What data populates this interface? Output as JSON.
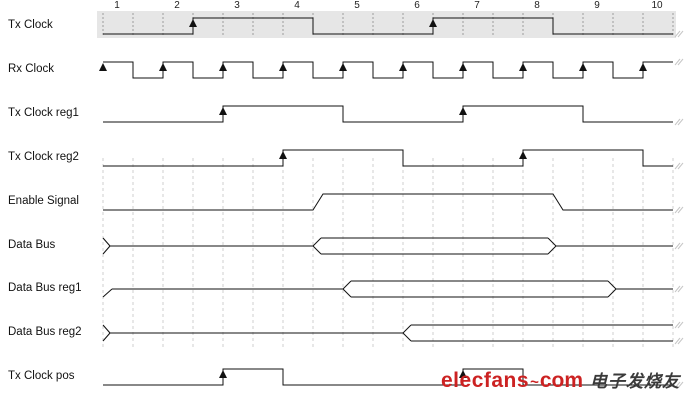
{
  "timeline": {
    "tick_labels": [
      "1",
      "2",
      "3",
      "4",
      "5",
      "6",
      "7",
      "8",
      "9",
      "10"
    ]
  },
  "colors": {
    "line": "#111111",
    "band_fill": "#e6e6e6",
    "band_dash": "#9c9c9c",
    "grid_dash": "#cfcfcf",
    "end_mark": "#c6c6c6",
    "watermark_red": "#cc2222",
    "watermark_cn": "#3a3a3a"
  },
  "signals": [
    {
      "name": "tx-clock",
      "label": "Tx Clock",
      "kind": "binary",
      "band": true,
      "levels": [
        [
          0,
          3,
          "low"
        ],
        [
          3,
          7,
          "high"
        ],
        [
          7,
          11,
          "low"
        ],
        [
          11,
          15,
          "high"
        ],
        [
          15,
          19,
          "low"
        ]
      ],
      "arrows": [
        3,
        11
      ],
      "slant": false
    },
    {
      "name": "rx-clock",
      "label": "Rx Clock",
      "kind": "binary",
      "levels": [
        [
          0,
          1,
          "high"
        ],
        [
          1,
          2,
          "low"
        ],
        [
          2,
          3,
          "high"
        ],
        [
          3,
          4,
          "low"
        ],
        [
          4,
          5,
          "high"
        ],
        [
          5,
          6,
          "low"
        ],
        [
          6,
          7,
          "high"
        ],
        [
          7,
          8,
          "low"
        ],
        [
          8,
          9,
          "high"
        ],
        [
          9,
          10,
          "low"
        ],
        [
          10,
          11,
          "high"
        ],
        [
          11,
          12,
          "low"
        ],
        [
          12,
          13,
          "high"
        ],
        [
          13,
          14,
          "low"
        ],
        [
          14,
          15,
          "high"
        ],
        [
          15,
          16,
          "low"
        ],
        [
          16,
          17,
          "high"
        ],
        [
          17,
          18,
          "low"
        ],
        [
          18,
          19,
          "high"
        ]
      ],
      "arrows": [
        0,
        2,
        4,
        6,
        8,
        10,
        12,
        14,
        16,
        18
      ],
      "slant": false
    },
    {
      "name": "tx-clock-reg1",
      "label": "Tx Clock reg1",
      "kind": "binary",
      "levels": [
        [
          0,
          4,
          "low"
        ],
        [
          4,
          8,
          "high"
        ],
        [
          8,
          12,
          "low"
        ],
        [
          12,
          16,
          "high"
        ],
        [
          16,
          19,
          "low"
        ]
      ],
      "arrows": [
        4,
        12
      ],
      "slant": false
    },
    {
      "name": "tx-clock-reg2",
      "label": "Tx Clock reg2",
      "kind": "binary",
      "levels": [
        [
          0,
          6,
          "low"
        ],
        [
          6,
          10,
          "high"
        ],
        [
          10,
          14,
          "low"
        ],
        [
          14,
          18,
          "high"
        ],
        [
          18,
          19,
          "low"
        ]
      ],
      "arrows": [
        6,
        14
      ],
      "slant": false
    },
    {
      "name": "enable-signal",
      "label": "Enable Signal",
      "kind": "binary",
      "levels": [
        [
          0,
          7,
          "low"
        ],
        [
          7,
          15,
          "high"
        ],
        [
          15,
          19,
          "low"
        ]
      ],
      "arrows": [],
      "slant": true
    },
    {
      "name": "data-bus",
      "label": "Data Bus",
      "kind": "bus",
      "start_style": "bowtie",
      "segments": [
        {
          "state": "idle",
          "from": 0,
          "to": 7
        },
        {
          "state": "valid",
          "from": 7,
          "to": 15.1
        },
        {
          "state": "idle",
          "from": 15.1,
          "to": 19
        }
      ],
      "open_ended": false
    },
    {
      "name": "data-bus-reg1",
      "label": "Data Bus reg1",
      "kind": "bus",
      "start_style": "ramp",
      "segments": [
        {
          "state": "idle",
          "from": 0,
          "to": 8
        },
        {
          "state": "valid",
          "from": 8,
          "to": 17.1
        },
        {
          "state": "idle",
          "from": 17.1,
          "to": 19
        }
      ],
      "open_ended": false
    },
    {
      "name": "data-bus-reg2",
      "label": "Data Bus reg2",
      "kind": "bus",
      "start_style": "bowtie",
      "segments": [
        {
          "state": "idle",
          "from": 0,
          "to": 10
        },
        {
          "state": "valid",
          "from": 10,
          "to": 19
        }
      ],
      "open_ended": true
    },
    {
      "name": "tx-clock-pos",
      "label": "Tx Clock pos",
      "kind": "binary",
      "levels": [
        [
          0,
          4,
          "low"
        ],
        [
          4,
          6,
          "high"
        ],
        [
          6,
          12,
          "low"
        ],
        [
          12,
          14,
          "high"
        ],
        [
          14,
          19,
          "low"
        ]
      ],
      "arrows": [
        4,
        12
      ],
      "slant": false
    }
  ],
  "watermark": {
    "brand": "elecfans",
    "swoosh": "~",
    "suffix": "com",
    "chinese": "电子发烧友"
  }
}
